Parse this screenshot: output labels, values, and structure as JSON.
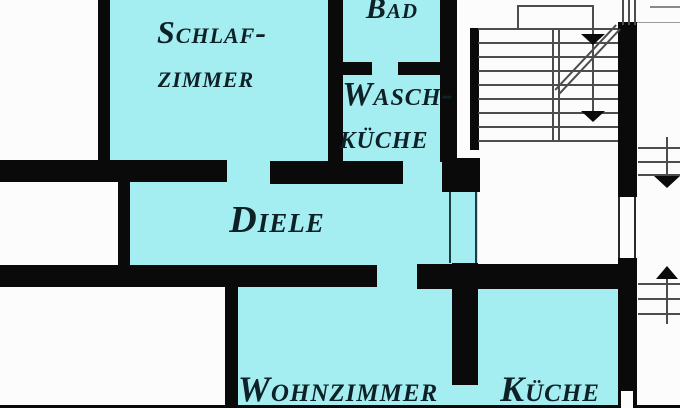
{
  "plan": {
    "rooms": {
      "schlafzimmer": {
        "label_line1": "Schlaf-",
        "label_line2": "zimmer"
      },
      "bad": {
        "label": "Bad"
      },
      "waschkueche": {
        "label_line1": "Wasch-",
        "label_line2": "küche"
      },
      "diele": {
        "label": "Diele"
      },
      "wohnzimmer": {
        "label": "Wohnzimmer"
      },
      "kueche": {
        "label": "Küche"
      }
    },
    "colors": {
      "room_fill": "#a4eef2",
      "wall": "#0a0a0a",
      "label_text": "#0d2126",
      "stair_line": "#4d4d4d",
      "background": "#fcfcfc"
    },
    "icons": {
      "staircase": "staircase-plan",
      "stair_direction_arrows": [
        "arrow-down",
        "arrow-down"
      ],
      "side_markers": [
        "arrow-down",
        "arrow-up"
      ]
    }
  }
}
